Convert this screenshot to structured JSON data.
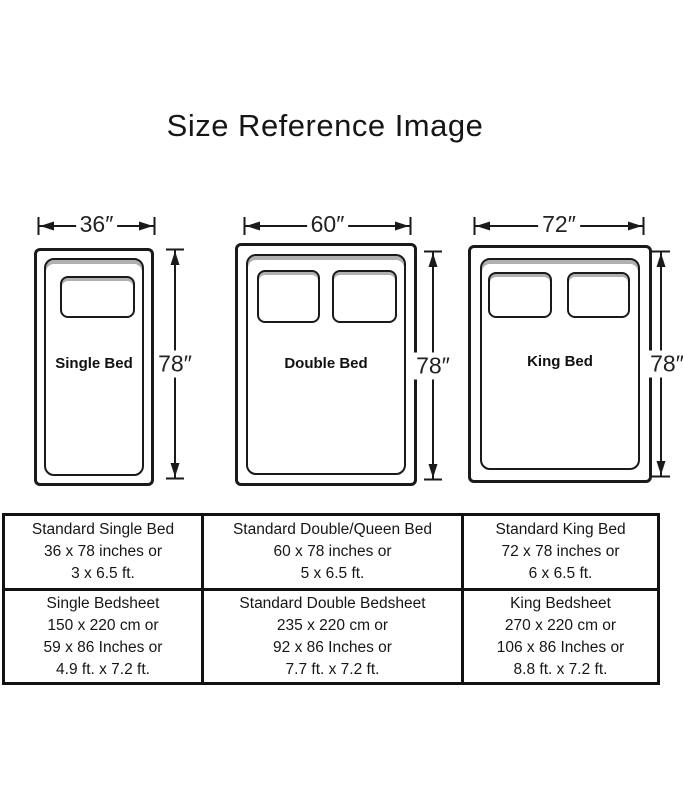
{
  "title": "Size Reference Image",
  "colors": {
    "ink": "#1a1a1a",
    "shadow_gray": "#b0b0b0",
    "background": "#ffffff"
  },
  "beds": [
    {
      "name": "Single Bed",
      "width_label": "36″",
      "height_label": "78″",
      "pillows": 1
    },
    {
      "name": "Double Bed",
      "width_label": "60″",
      "height_label": "78″",
      "pillows": 2
    },
    {
      "name": "King Bed",
      "width_label": "72″",
      "height_label": "78″",
      "pillows": 2
    }
  ],
  "table": {
    "rows": [
      {
        "cells": [
          {
            "lines": [
              "Standard Single Bed",
              "36 x 78 inches or",
              "3 x 6.5 ft."
            ]
          },
          {
            "lines": [
              "Standard Double/Queen Bed",
              "60 x 78 inches or",
              "5 x 6.5 ft."
            ]
          },
          {
            "lines": [
              "Standard King Bed",
              "72 x 78 inches or",
              "6 x 6.5 ft."
            ]
          }
        ]
      },
      {
        "cells": [
          {
            "lines": [
              "Single Bedsheet",
              "150 x 220 cm or",
              "59 x 86 Inches or",
              "4.9 ft. x 7.2 ft."
            ]
          },
          {
            "lines": [
              "Standard Double Bedsheet",
              "235 x 220 cm or",
              "92 x 86 Inches or",
              "7.7 ft. x 7.2 ft."
            ]
          },
          {
            "lines": [
              "King Bedsheet",
              "270 x 220 cm or",
              "106 x 86 Inches or",
              "8.8 ft. x 7.2 ft."
            ]
          }
        ]
      }
    ]
  }
}
